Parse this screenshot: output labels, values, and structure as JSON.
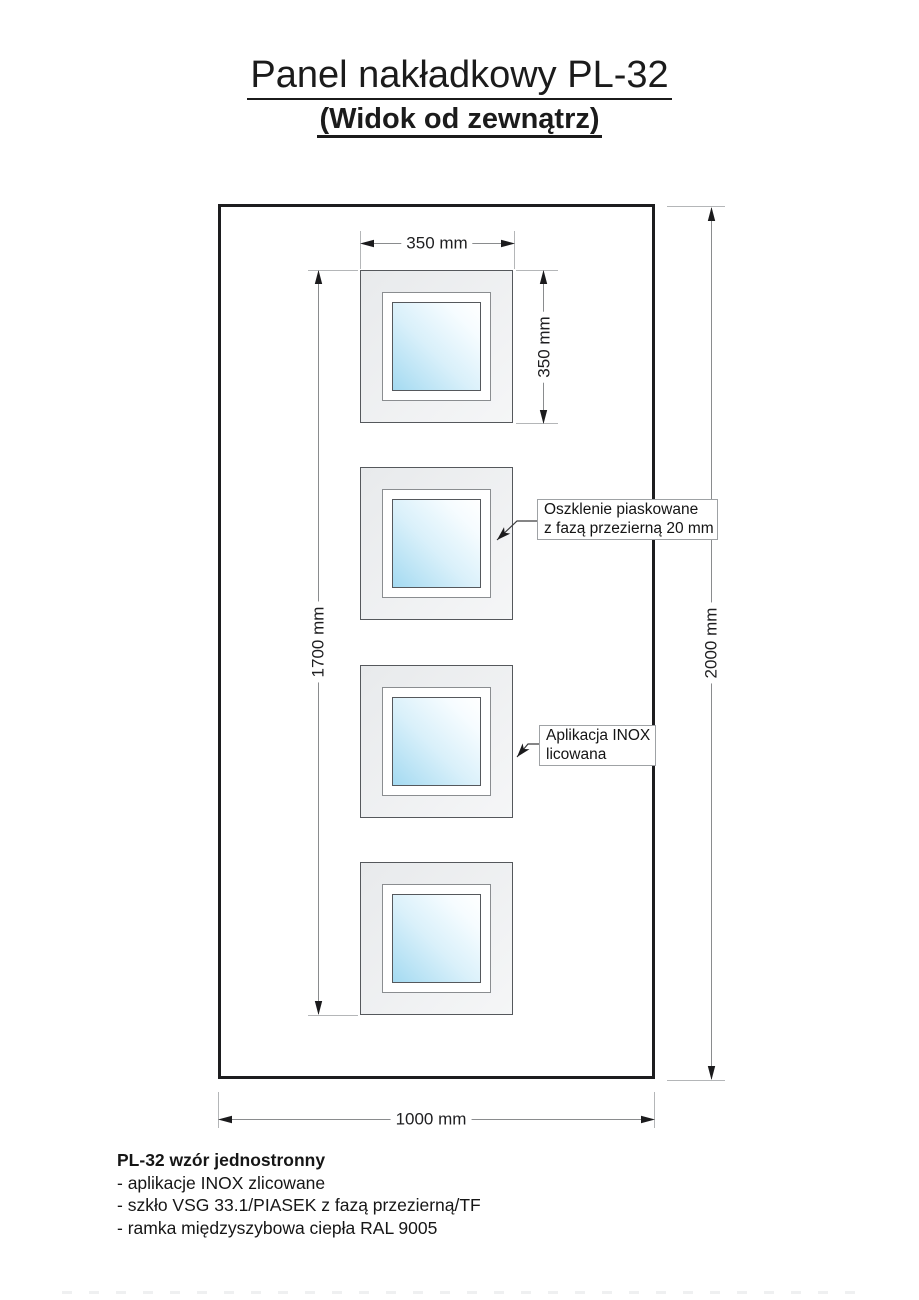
{
  "title": {
    "line1": "Panel nakładkowy PL-32",
    "line2": "(Widok od zewnątrz)"
  },
  "dimensions": {
    "window_width": "350 mm",
    "window_height": "350 mm",
    "windows_span": "1700 mm",
    "panel_height": "2000 mm",
    "panel_width": "1000 mm"
  },
  "callouts": {
    "glazing": {
      "line1": "Oszklenie piaskowane",
      "line2": "z fazą przezierną 20 mm"
    },
    "inox": {
      "line1": "Aplikacja INOX",
      "line2": "licowana"
    }
  },
  "notes": {
    "heading": "PL-32 wzór jednostronny",
    "items": [
      "- aplikacje INOX zlicowane",
      "- szkło VSG 33.1/PIASEK z fazą przezierną/TF",
      "- ramka międzyszybowa ciepła RAL 9005"
    ]
  },
  "colors": {
    "glass_blue": "#a4daf1",
    "panel_line": "#1d1d1f",
    "frame_fill": "#eef0f1"
  }
}
